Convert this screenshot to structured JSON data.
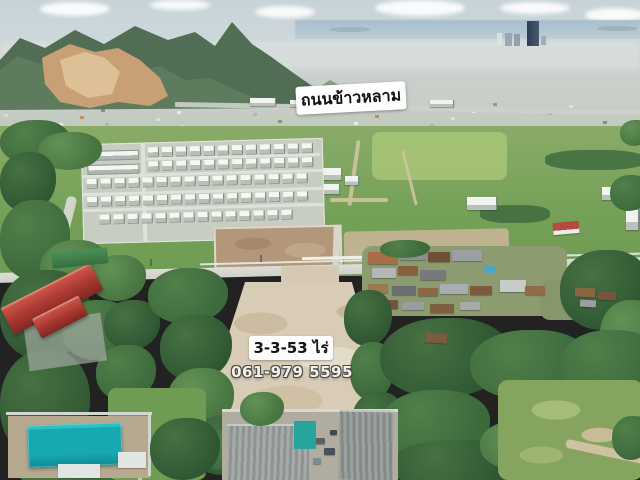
{
  "meta": {
    "type": "aerial-drone-photo",
    "description": "Aerial drone photo of a vacant land plot for sale, surrounded by trees, a housing estate, fields, a village and warehouses, with mountains, a quarry and a coastal city skyline in the distance"
  },
  "overlays": {
    "road_label": "ถนนข้าวหลาม",
    "area_label": "3-3-53 ไร่",
    "phone_label": "061-979 5595"
  },
  "palette": {
    "sky": "#c6d3d8",
    "sea_haze": "#a9bfcd",
    "mountain_green": "#516e55",
    "quarry_rock": "#c9a076",
    "city_haze": "#c9d2d4",
    "skyscraper": "#2c3e54",
    "field_green": "#74a057",
    "tree_dark": "#2f5633",
    "plot_dirt": "#d8ccb7",
    "tilled_field": "#b2977a",
    "road_grey": "#d2d3cd",
    "teal_roof": "#17a9b0",
    "red_roof": "#b03c34",
    "warehouse_grey": "#9ba19f",
    "label_background": "#fefefe",
    "label_text": "#121212",
    "phone_text": "#f4f1ea"
  }
}
